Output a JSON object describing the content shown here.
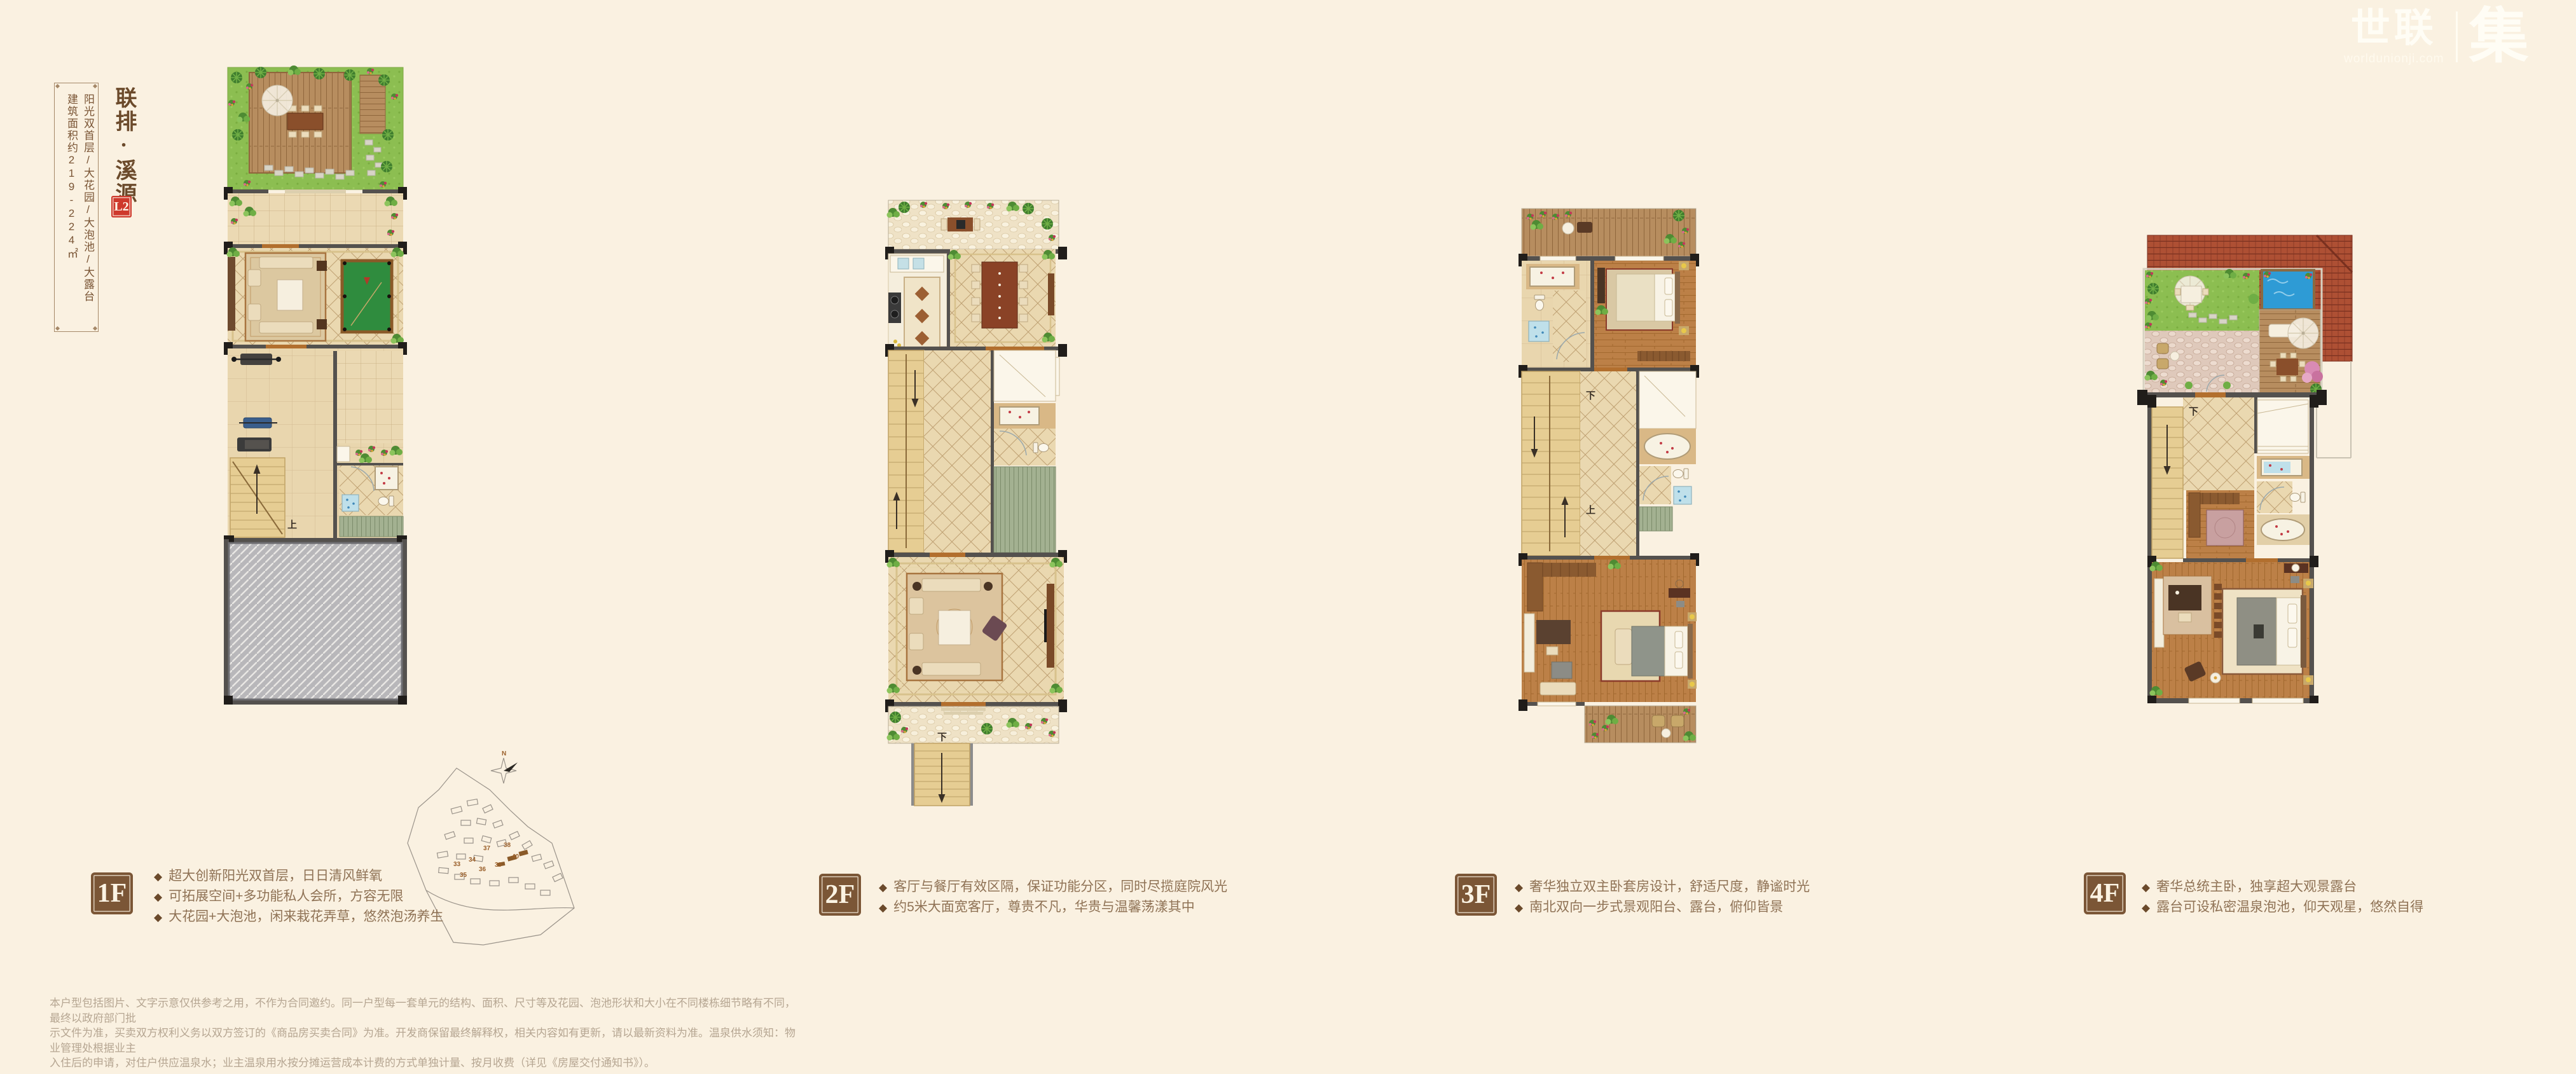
{
  "page": {
    "background": "#FAF1E1"
  },
  "logo": {
    "brand_left": "世联",
    "brand_right": "集",
    "domain": "worldunionji.com"
  },
  "title_block": {
    "title": "联排·溪源",
    "unit_badge": "L2",
    "features": "阳光双首层/大花园/大泡池/大露台",
    "area": "建筑面积约219-224㎡"
  },
  "ui": {
    "bullet_marker": "◆"
  },
  "stairs": {
    "up": "上",
    "down": "下"
  },
  "site_plan": {
    "north": "N",
    "numbers": [
      "33",
      "34",
      "35",
      "36",
      "37",
      "38",
      "39",
      "40"
    ]
  },
  "floors": [
    {
      "label": "1F",
      "bullets": [
        "超大创新阳光双首层，日日清风鲜氧",
        "可拓展空间+多功能私人会所，方容无限",
        "大花园+大泡池，闲来栽花弄草，悠然泡汤养生"
      ]
    },
    {
      "label": "2F",
      "bullets": [
        "客厅与餐厅有效区隔，保证功能分区，同时尽揽庭院风光",
        "约5米大面宽客厅，尊贵不凡，华贵与温馨荡漾其中"
      ]
    },
    {
      "label": "3F",
      "bullets": [
        "奢华独立双主卧套房设计，舒适尺度，静谧时光",
        "南北双向一步式景观阳台、露台，俯仰皆景"
      ]
    },
    {
      "label": "4F",
      "bullets": [
        "奢华总统主卧，独享超大观景露台",
        "露台可设私密温泉泡池，仰天观星，悠然自得"
      ]
    }
  ],
  "disclaimer_lines": [
    "本户型包括图片、文字示意仅供参考之用，不作为合同邀约。同一户型每一套单元的结构、面积、尺寸等及花园、泡池形状和大小在不同楼栋细节略有不同，最终以政府部门批",
    "示文件为准，买卖双方权利义务以双方签订的《商品房买卖合同》为准。开发商保留最终解释权，相关内容如有更新，请以最新资料为准。温泉供水须知：物业管理处根据业主",
    "入住后的申请，对住户供应温泉水；业主温泉用水按分摊运营成本计费的方式单独计量、按月收费（详见《房屋交付通知书》）。"
  ],
  "colors": {
    "accent_red": "#CE392C",
    "badge_brown": "#7B5636",
    "title_brown": "#6B4A2B",
    "body_text": "#8F7255",
    "disclaimer_text": "#B6A692",
    "background": "#FAF1E1"
  }
}
